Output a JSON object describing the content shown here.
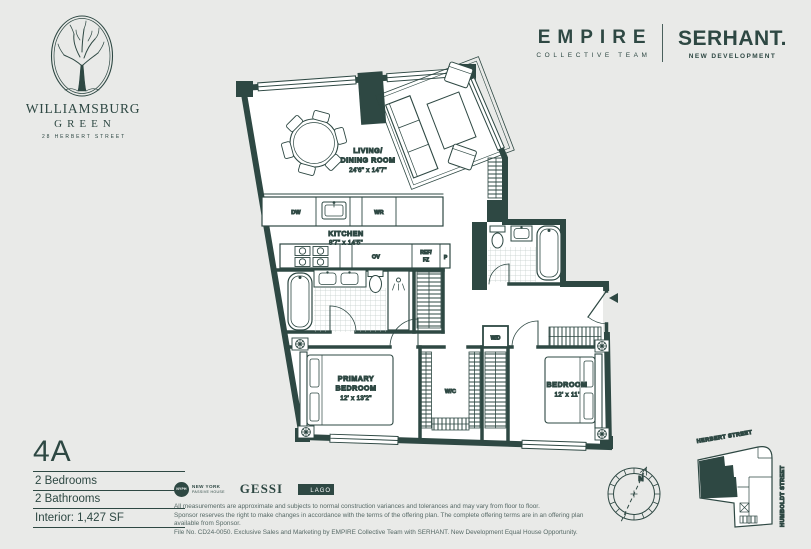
{
  "colors": {
    "ink": "#2e4843",
    "background": "#e9eae8",
    "paper": "#ffffff",
    "muted_text": "#566966"
  },
  "header": {
    "building": {
      "name_line1": "WILLIAMSBURG",
      "name_line2": "GREEN",
      "address": "28 HERBERT STREET"
    },
    "agency": {
      "primary": "EMPIRE",
      "primary_sub": "COLLECTIVE TEAM",
      "secondary": "SERHANT.",
      "secondary_sub": "NEW DEVELOPMENT"
    }
  },
  "unit": {
    "label": "4A",
    "specs": [
      "2 Bedrooms",
      "2 Bathrooms",
      "Interior: 1,427 SF"
    ]
  },
  "plan": {
    "living": {
      "line1": "LIVING/",
      "line2": "DINING ROOM",
      "dims": "24'6\" x 14'7\""
    },
    "kitchen": {
      "name": "KITCHEN",
      "dims": "8'7\" x 14'5\""
    },
    "primary_bedroom": {
      "line1": "PRIMARY",
      "line2": "BEDROOM",
      "dims": "12' x 13'2\""
    },
    "bedroom": {
      "name": "BEDROOM",
      "dims": "12' x 11'"
    },
    "labels": {
      "dw": "DW",
      "wr": "WR",
      "ov": "OV",
      "ref_line1": "REF/",
      "ref_line2": "FZ",
      "pantry": "P",
      "wd": "W/D",
      "wic": "W/C"
    },
    "compass_n": "N"
  },
  "keymap": {
    "street_top": "HERBERT STREET",
    "street_right": "HUMBOLDT STREET"
  },
  "footer": {
    "nyph": {
      "badge": "NYPH",
      "line1": "NEW YORK",
      "line2": "PASSIVE HOUSE"
    },
    "gessi": "GESSI",
    "lago": "LAGO",
    "disclaimer": [
      "All measurements are approximate and subjects to normal construction variances and tolerances and may vary from floor to floor.",
      "Sponsor reserves the right to make changes in accordance with the terms of the offering plan. The complete offering terms are in an offering plan available from Sponsor.",
      "File No. CD24-0050. Exclusive Sales and Marketing by EMPIRE Collective Team with SERHANT. New Development Equal House Opportunity."
    ]
  }
}
